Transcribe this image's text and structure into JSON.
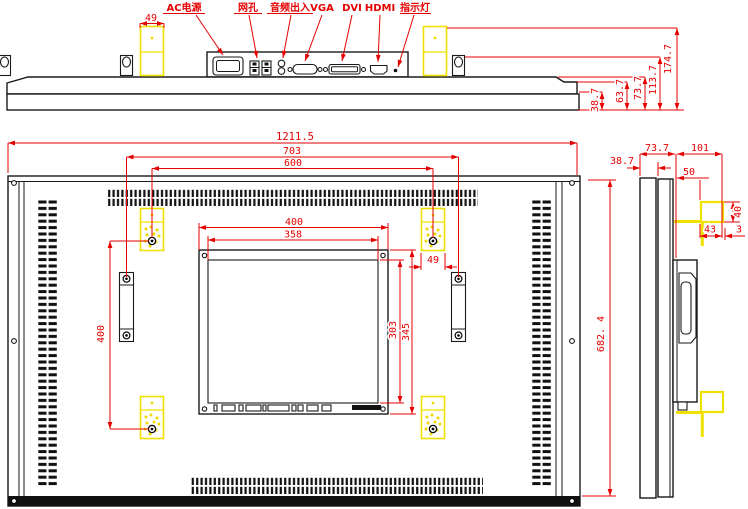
{
  "top": {
    "ports": {
      "power": "AC电源",
      "lan": "网孔",
      "audio": "音频出入",
      "vga": "VGA",
      "dvi": "DVI",
      "hdmi": "HDMI",
      "indicator": "指示灯"
    },
    "dims": {
      "bracket_width": "49",
      "h1": "38.7",
      "h2": "63.7",
      "h3": "73.7",
      "h4": "113.7",
      "h5": "174.7"
    }
  },
  "front": {
    "dims": {
      "total_width": "1211.5",
      "handle_span": "703",
      "mount_width": "600",
      "mount_height": "400",
      "plate_width": "400",
      "window_width": "358",
      "window_height": "303",
      "plate_height": "345",
      "bracket_width": "49",
      "total_height": "682. 4"
    }
  },
  "side": {
    "dims": {
      "front_depth": "73.7",
      "back_depth": "101",
      "panel_thickness": "38.7",
      "box_depth": "50",
      "hook_height": "40",
      "hook_width": "43",
      "hook_lip": "3"
    }
  },
  "colors": {
    "line": "#1a1a1a",
    "dimension_red": "#e60000",
    "highlight_yellow": "#f0e000"
  }
}
